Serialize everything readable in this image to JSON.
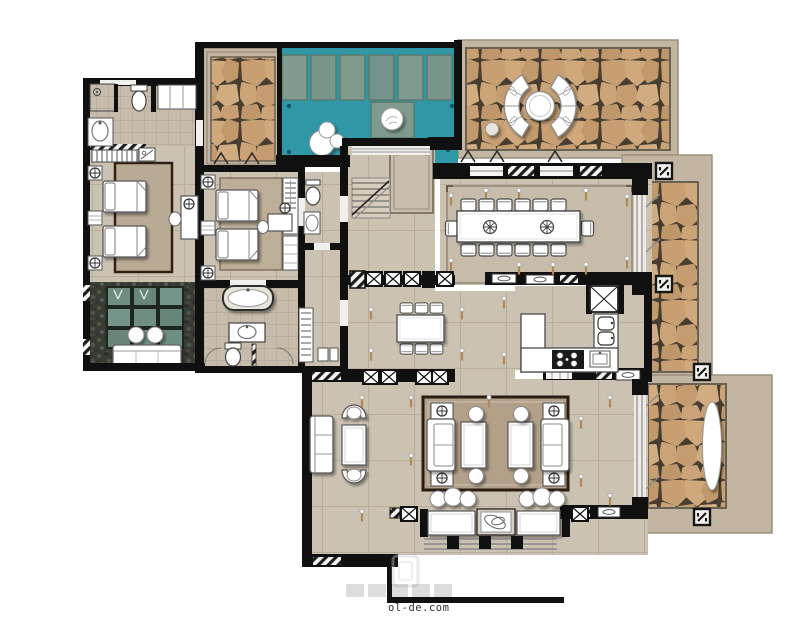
{
  "canvas": {
    "width": 800,
    "height": 641,
    "background": "#ffffff"
  },
  "watermark": {
    "text": "ol-de.com"
  },
  "palette": {
    "wall": "#101010",
    "interior_floor": "#ccc2b1",
    "floor_grid_line": "#b9ae9b",
    "outdoor_paving": "#c2b6a3",
    "cobblestone": "#c9a173",
    "cobblestone_joint": "#473e31",
    "pool_water": "#2f97a6",
    "stone_slab_green": "#7e9b8d",
    "pebble_dark": "#383b33",
    "courtyard_slab": "#6f8e81",
    "rug_dark_border": "#2a1c10",
    "rug_brown": "#b2a089",
    "furniture_white": "#ffffff",
    "furniture_stroke": "#4a4a4a"
  },
  "rooms": [
    {
      "id": "bedroom-1",
      "label": "guest bedroom west",
      "furniture": [
        "twin-bed",
        "twin-bed",
        "nightstand",
        "nightstand",
        "nightstand",
        "area-rug",
        "desk",
        "desk-chair"
      ]
    },
    {
      "id": "bathroom-1",
      "label": "bathroom west",
      "furniture": [
        "shower",
        "toilet",
        "washbasin",
        "slatted-bench",
        "shelf-unit"
      ]
    },
    {
      "id": "courtyard",
      "label": "private courtyard",
      "furniture": [
        "green-slab-grid",
        "pebble-border",
        "garden-bench",
        "garden-stool",
        "garden-stool",
        "shrub",
        "shrub"
      ]
    },
    {
      "id": "bedroom-2",
      "label": "guest bedroom middle",
      "furniture": [
        "twin-bed",
        "twin-bed",
        "nightstand",
        "nightstand",
        "nightstand",
        "area-rug",
        "desk",
        "desk-chair",
        "wardrobe-hangers",
        "shelves"
      ]
    },
    {
      "id": "bathroom-2",
      "label": "main bathroom",
      "furniture": [
        "bathtub",
        "vanity-basin",
        "toilet"
      ]
    },
    {
      "id": "powder-room",
      "label": "powder room",
      "furniture": [
        "toilet",
        "washbasin"
      ]
    },
    {
      "id": "hall-closet",
      "label": "closet corridor",
      "furniture": [
        "wardrobe-hangers",
        "storage-boxes"
      ]
    },
    {
      "id": "entry-hall",
      "label": "entry hall",
      "furniture": [
        "staircase",
        "area-rug"
      ]
    },
    {
      "id": "plunge-pool",
      "label": "plunge pool",
      "furniture": [
        "stone-slab",
        "stone-slab",
        "stone-slab",
        "stone-slab",
        "stone-slab",
        "stone-slab",
        "stepping-pad",
        "sphere-sculpture-group",
        "sphere-on-pad"
      ]
    },
    {
      "id": "stone-court-nw",
      "label": "cobblestone court northwest",
      "furniture": []
    },
    {
      "id": "patio-ne",
      "label": "cobblestone patio northeast",
      "furniture": [
        "curved-bench",
        "curved-bench",
        "round-table",
        "sphere-ornament"
      ]
    },
    {
      "id": "dining-room",
      "label": "dining room",
      "furniture": [
        "dining-table",
        "dining-chairs-14",
        "centerpiece",
        "centerpiece"
      ]
    },
    {
      "id": "kitchen",
      "label": "kitchen",
      "furniture": [
        "l-shaped-counter",
        "cooktop-4-burner",
        "sink",
        "refrigerator",
        "double-oven"
      ]
    },
    {
      "id": "breakfast-nook",
      "label": "breakfast nook",
      "furniture": [
        "table",
        "chairs-6"
      ]
    },
    {
      "id": "living-room",
      "label": "living room",
      "furniture": [
        "wall-sofa",
        "armchair",
        "armchair",
        "lounge-table",
        "sofa",
        "sofa",
        "coffee-table",
        "coffee-table",
        "side-table-4",
        "round-stool-4",
        "pouf-6",
        "area-rug"
      ]
    },
    {
      "id": "porch",
      "label": "south porch",
      "furniture": [
        "planter",
        "planter",
        "ornament-box",
        "steps",
        "columns"
      ]
    },
    {
      "id": "path-east",
      "label": "cobblestone path east",
      "furniture": [
        "column-marker",
        "column-marker"
      ]
    },
    {
      "id": "patio-se",
      "label": "cobblestone patio southeast",
      "furniture": [
        "oval-planter",
        "column-marker",
        "column-marker"
      ]
    }
  ]
}
